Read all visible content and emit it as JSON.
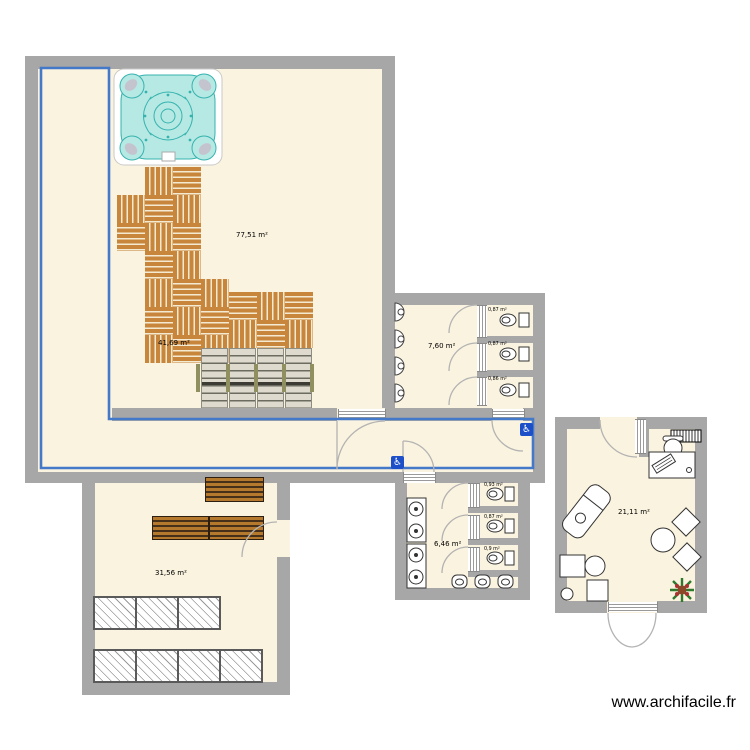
{
  "watermark": {
    "text": "www.archifacile.fr"
  },
  "rooms": {
    "pool_hall": {
      "area_label": "77,51 m²"
    },
    "walkway": {
      "area_label": "41,69 m²"
    },
    "wc_right": {
      "area_label": "7,60 m²"
    },
    "wc_bottom": {
      "area_label": "6,46 m²"
    },
    "office": {
      "area_label": "21,11 m²"
    },
    "changing_room": {
      "area_label": "31,56 m²"
    }
  },
  "wc_right_stalls": [
    "0,87 m²",
    "0,87 m²",
    "0,86 m²"
  ],
  "wc_bottom_stalls": [
    "0,93 m²",
    "0,87 m²",
    "0,9 m²"
  ],
  "icons": {
    "accessible_badge": "♿"
  },
  "colors": {
    "selection_blue": "#4478c8",
    "wall_gray": "#a7a7a7",
    "floor_cream": "#faf3df",
    "pool_water": "#16d5f0",
    "pool_deck_tan": "#e9e0ba",
    "deck_wood": "#c8853c"
  }
}
